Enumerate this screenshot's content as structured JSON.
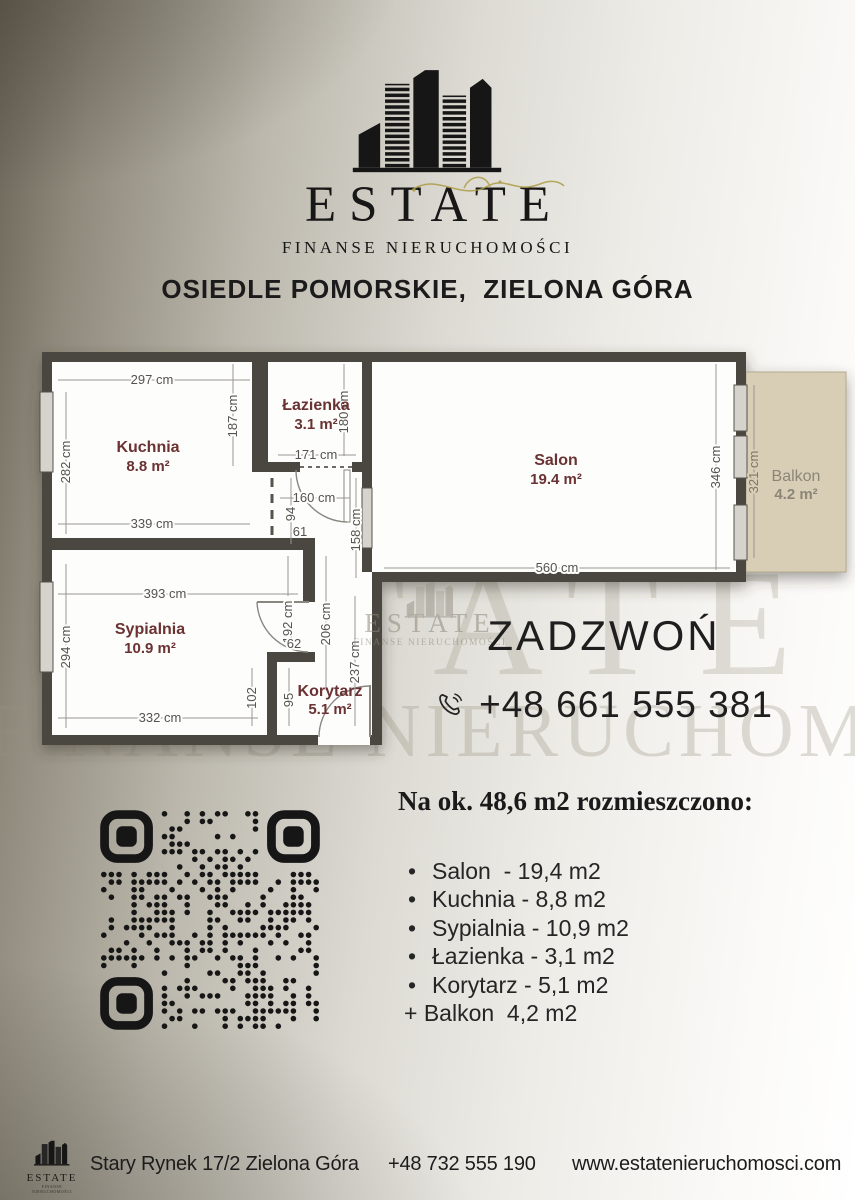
{
  "logo": {
    "name": "ESTATE",
    "subtitle": "FINANSE NIERUCHOMOŚCI"
  },
  "heading": "OSIEDLE POMORSKIE,  ZIELONA GÓRA",
  "watermark": {
    "big_estate": "ESTATE",
    "big_line": "FINANSE NIERUCHOMOŚCI",
    "center": {
      "name": "ESTATE",
      "subtitle": "FINANSE NIERUCHOMOŚCI"
    }
  },
  "plan": {
    "rooms": {
      "kuchnia": {
        "name": "Kuchnia",
        "area": "8.8 m²"
      },
      "lazienka": {
        "name": "Łazienka",
        "area": "3.1 m²"
      },
      "salon": {
        "name": "Salon",
        "area": "19.4 m²"
      },
      "sypialnia": {
        "name": "Sypialnia",
        "area": "10.9 m²"
      },
      "korytarz": {
        "name": "Korytarz",
        "area": "5.1 m²"
      },
      "balkon": {
        "name": "Balkon",
        "area": "4.2 m²"
      }
    },
    "dims": {
      "kuchnia_top": "297 cm",
      "kuchnia_left": "282 cm",
      "kuchnia_inner": "187 cm",
      "kuchnia_bottom": "339 cm",
      "lazienka_side": "180 cm",
      "lazienka_bottom": "171 cm",
      "hall_width": "160 cm",
      "hall_94": "94",
      "hall_61": "61",
      "hall_158": "158 cm",
      "salon_side": "346 cm",
      "salon_bottom": "560 cm",
      "balkon_side": "321 cm",
      "sypialnia_top": "393 cm",
      "sypialnia_left": "294 cm",
      "syp_192": "192 cm",
      "hall_206": "206 cm",
      "door_62": "62",
      "hall_237": "237 cm",
      "syp_102": "102",
      "hall_95": "95",
      "sypialnia_bottom": "332 cm"
    },
    "colors": {
      "wall": "#4a463f",
      "room_label": "#6b3030",
      "balkon_fill": "#d8cdb5"
    }
  },
  "contact": {
    "call_label": "ZADZWOŃ",
    "phone": "+48 661 555 381"
  },
  "summary": {
    "heading": "Na ok. 48,6 m2 rozmieszczono:",
    "items": [
      "Salon  - 19,4 m2",
      "Kuchnia - 8,8 m2",
      "Sypialnia - 10,9 m2",
      "Łazienka - 3,1 m2",
      "Korytarz - 5,1 m2"
    ],
    "balkon_line": "+ Balkon  4,2 m2"
  },
  "footer": {
    "logo_name": "ESTATE",
    "logo_subtitle": "FINANSE NIERUCHOMOŚCI",
    "address": "Stary Rynek 17/2 Zielona Góra",
    "phone": "+48 732 555 190",
    "website": "www.estatenieruchomosci.com"
  }
}
